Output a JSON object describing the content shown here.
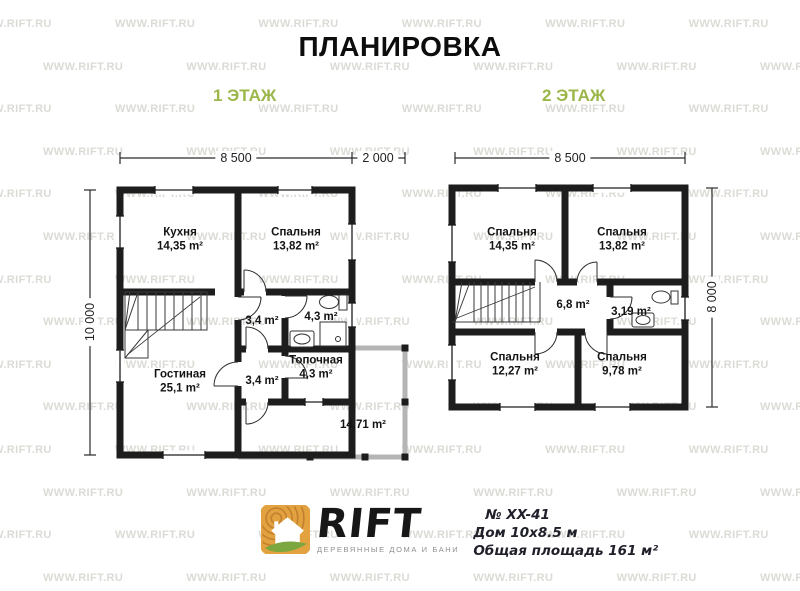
{
  "title": "ПЛАНИРОВКА",
  "watermark": {
    "text": "WWW.RIFT.RU",
    "color": "#dbdbd6"
  },
  "colors": {
    "wall": "#1d1d1d",
    "terrace": "#b5b5b5",
    "accent_green": "#9bb649",
    "logo_orange": "#e2a23f",
    "logo_rings": "#c4802f",
    "logo_leaf": "#7ca73e"
  },
  "floor1": {
    "label": "1 ЭТАЖ",
    "dim_width_main": "8 500",
    "dim_width_terrace": "2 000",
    "dim_height": "10 000",
    "rooms": {
      "kitchen": {
        "name": "Кухня",
        "area": "14,35 m²"
      },
      "bedroom": {
        "name": "Спальня",
        "area": "13,82 m²"
      },
      "hall_upper": {
        "area": "3,4 m²"
      },
      "bathroom": {
        "area": "4,3 m²"
      },
      "hall_lower": {
        "area": "3,4 m²"
      },
      "boiler": {
        "name": "Топочная",
        "area": "4,3 m²"
      },
      "living": {
        "name": "Гостиная",
        "area": "25,1 m²"
      },
      "terrace": {
        "area": "14,71 m²"
      }
    }
  },
  "floor2": {
    "label": "2 ЭТАЖ",
    "dim_width": "8 500",
    "dim_height": "8 000",
    "rooms": {
      "bedroom1": {
        "name": "Спальня",
        "area": "14,35 m²"
      },
      "bedroom2": {
        "name": "Спальня",
        "area": "13,82 m²"
      },
      "hall": {
        "area": "6,8 m²"
      },
      "bathroom": {
        "area": "3,19 m²"
      },
      "bedroom3": {
        "name": "Спальня",
        "area": "12,27 m²"
      },
      "bedroom4": {
        "name": "Спальня",
        "area": "9,78 m²"
      }
    }
  },
  "footer": {
    "brand": "RIFT",
    "tagline": "ДЕРЕВЯННЫЕ ДОМА И БАНИ",
    "project_number": "№ XX-41",
    "house_size": "Дом 10х8.5 м",
    "total_area": "Общая площадь 161 м²"
  }
}
